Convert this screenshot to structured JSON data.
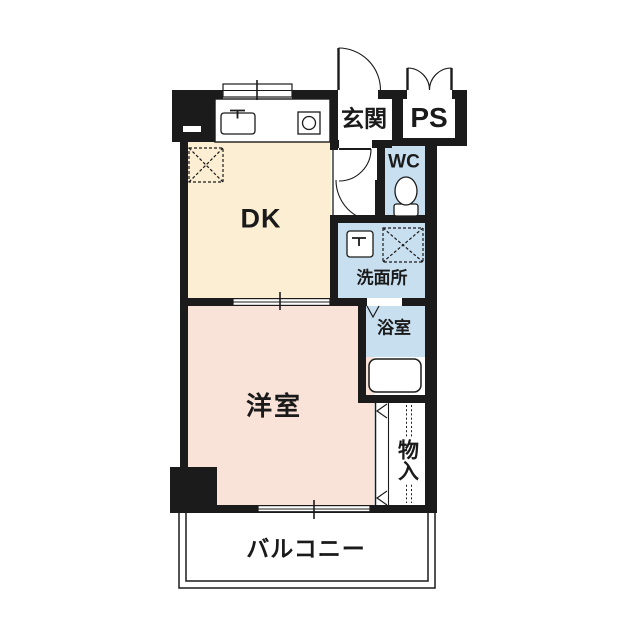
{
  "title": "apartment-floor-plan",
  "rooms": {
    "dk": "DK",
    "genkan": "玄関",
    "ps": "PS",
    "wc": "WC",
    "senmenjo": "洗面所",
    "yokushitsu": "浴室",
    "yoshitsu": "洋室",
    "monoire": "物入",
    "balcony": "バルコニー"
  },
  "colors": {
    "wall": "#1b1b1b",
    "line": "#1b1b1b",
    "dk_fill": "#fbeed3",
    "western_room_fill": "#f9e2d8",
    "wet_area_fill": "#c8dff0",
    "background": "#ffffff"
  },
  "fixtures": {
    "kitchen_counter": "kitchen-counter",
    "kitchen_sink": "kitchen-sink",
    "stove": "gas-stove",
    "refrigerator_space": "refrigerator-space",
    "entry_door": "entry-door",
    "ps_doors": "ps-double-doors",
    "hall_doors": "hall-doors",
    "toilet": "toilet",
    "washbasin": "washbasin",
    "washing_machine_space": "washing-machine-space",
    "bathtub": "bathtub",
    "bath_door": "bath-folding-door",
    "closet_doors": "closet-doors",
    "windows": "sliding-windows"
  }
}
